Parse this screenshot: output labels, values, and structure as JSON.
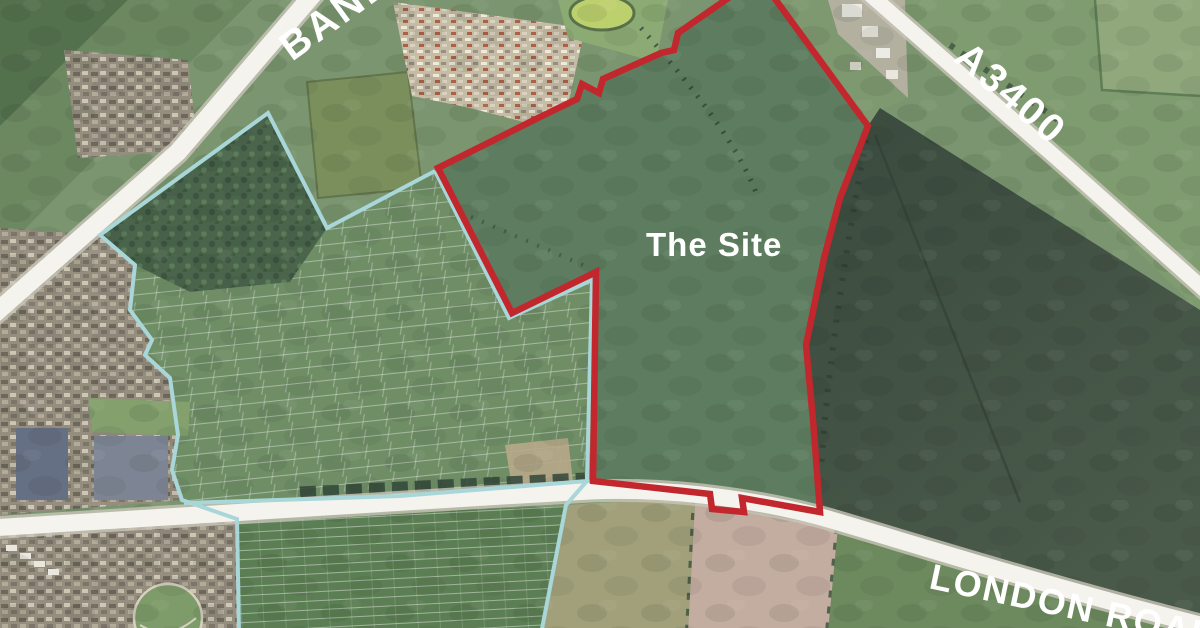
{
  "map": {
    "type": "aerial-site-plan",
    "labels": {
      "site": "The Site",
      "road_top_left": "BANBURY ROAD",
      "road_top_right": "A3400",
      "road_bottom_right": "LONDON ROAD"
    },
    "colors": {
      "site_boundary": "#c1272d",
      "context_boundary": "#a9d7d9",
      "road_fill": "#f4f3ee",
      "label_text": "#ffffff"
    }
  }
}
